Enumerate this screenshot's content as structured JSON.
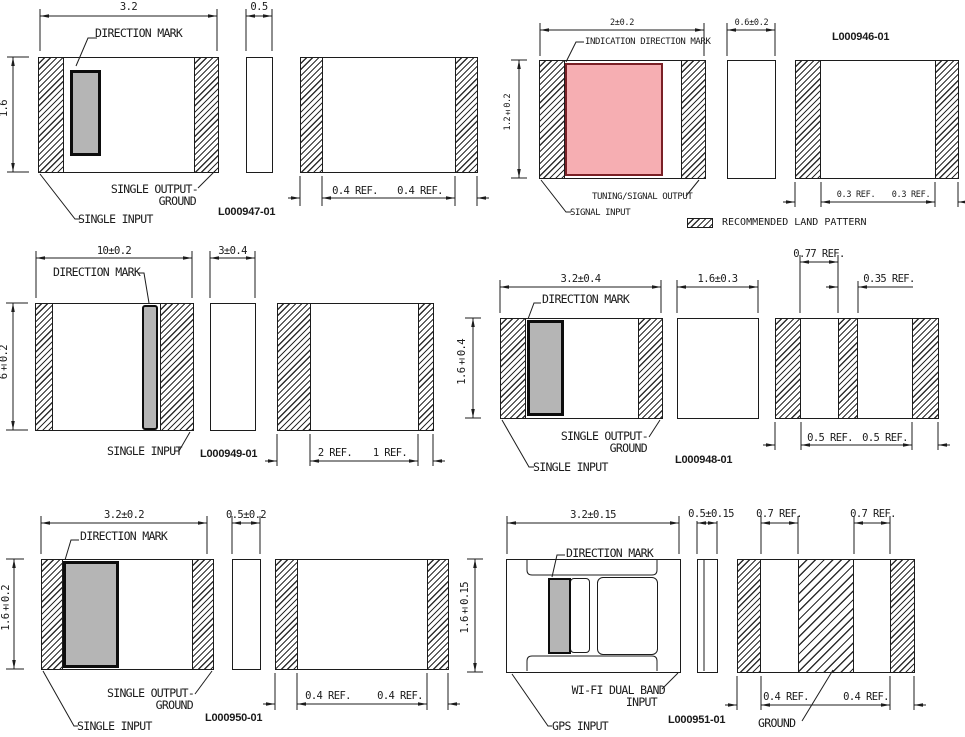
{
  "legend": {
    "label": "RECOMMENDED LAND PATTERN"
  },
  "colors": {
    "line": "#1c1c1c",
    "direction_mark_fill": "#b5b5b5",
    "indication_mark_fill": "#f6aeb2",
    "indication_mark_border": "#7a2026"
  },
  "panels": [
    {
      "part_number": "L000947-01",
      "dims": {
        "width": "3.2",
        "height": "1.6",
        "side": "0.5",
        "land": [
          "0.4 REF.",
          "0.4 REF."
        ]
      },
      "labels": {
        "mark": "DIRECTION MARK",
        "output1": "SINGLE OUTPUT-",
        "output2": "GROUND",
        "input": "SINGLE INPUT"
      }
    },
    {
      "part_number": "L000946-01",
      "dims": {
        "width": "2±0.2",
        "height": "1.2±0.2",
        "side": "0.6±0.2",
        "land": [
          "0.3 REF.",
          "0.3 REF."
        ]
      },
      "labels": {
        "mark": "INDICATION DIRECTION MARK",
        "output": "TUNING/SIGNAL OUTPUT",
        "input": "SIGNAL INPUT"
      }
    },
    {
      "part_number": "L000949-01",
      "dims": {
        "width": "10±0.2",
        "height": "6±0.2",
        "side": "3±0.4",
        "land": [
          "2 REF.",
          "1 REF."
        ]
      },
      "labels": {
        "mark": "DIRECTION MARK",
        "input": "SINGLE INPUT"
      }
    },
    {
      "part_number": "L000948-01",
      "dims": {
        "width": "3.2±0.4",
        "height": "1.6±0.4",
        "side": "1.6±0.3",
        "land_top": [
          "0.77 REF.",
          "0.35 REF."
        ],
        "land": [
          "0.5 REF.",
          "0.5 REF."
        ]
      },
      "labels": {
        "mark": "DIRECTION MARK",
        "output1": "SINGLE OUTPUT-",
        "output2": "GROUND",
        "input": "SINGLE INPUT"
      }
    },
    {
      "part_number": "L000950-01",
      "dims": {
        "width": "3.2±0.2",
        "height": "1.6±0.2",
        "side": "0.5±0.2",
        "land": [
          "0.4 REF.",
          "0.4 REF."
        ]
      },
      "labels": {
        "mark": "DIRECTION MARK",
        "output1": "SINGLE OUTPUT-",
        "output2": "GROUND",
        "input": "SINGLE INPUT"
      }
    },
    {
      "part_number": "L000951-01",
      "dims": {
        "width": "3.2±0.15",
        "height": "1.6±0.15",
        "side": "0.5±0.15",
        "land_top": [
          "0.7 REF.",
          "0.7 REF."
        ],
        "land": [
          "0.4 REF.",
          "0.4 REF."
        ]
      },
      "labels": {
        "mark": "DIRECTION MARK",
        "wifi1": "WI-FI DUAL BAND",
        "wifi2": "INPUT",
        "gps": "GPS INPUT",
        "ground": "GROUND"
      }
    }
  ]
}
